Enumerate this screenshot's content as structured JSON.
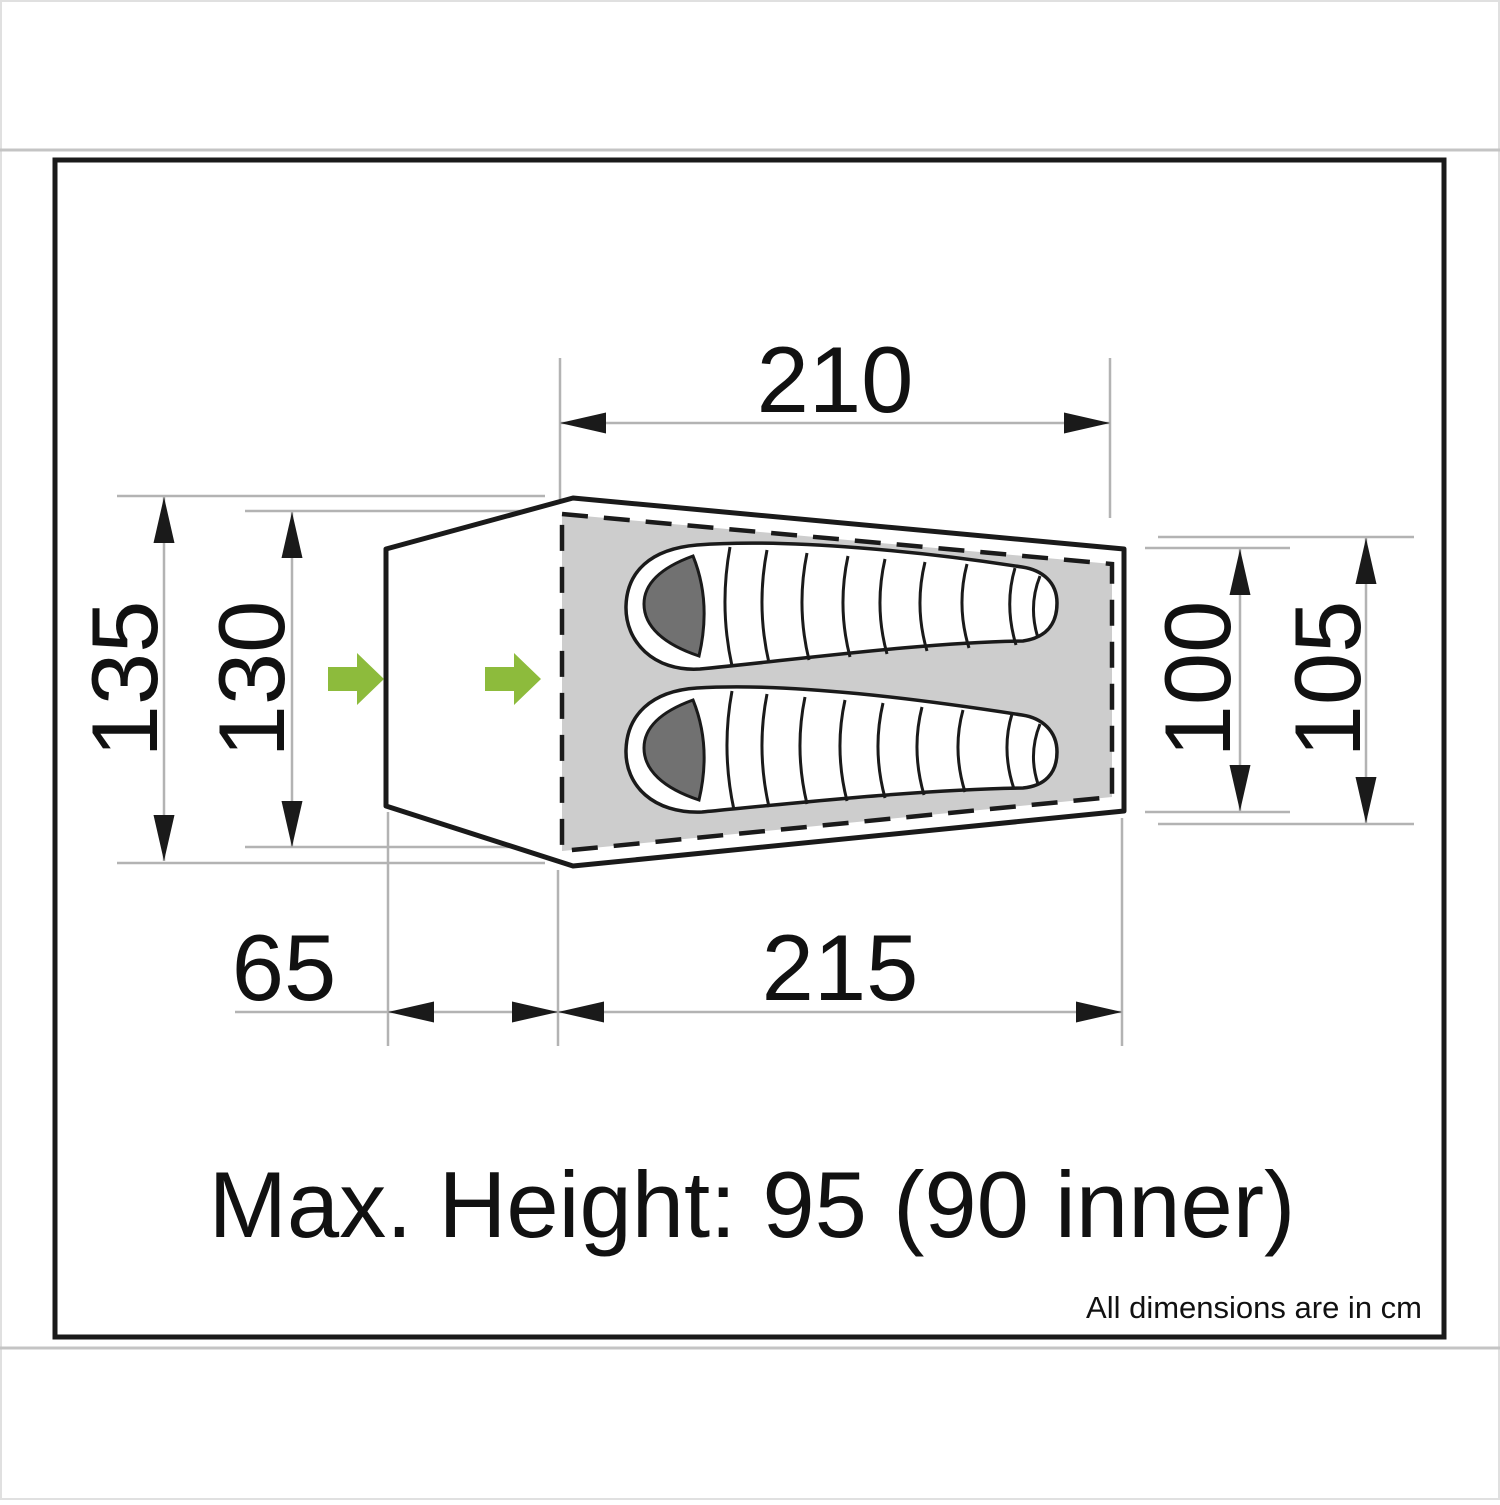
{
  "dimensions": {
    "top_length": "210",
    "left_outer_width": "135",
    "left_inner_width": "130",
    "right_inner_width": "100",
    "right_outer_width": "105",
    "porch_depth": "65",
    "floor_length": "215"
  },
  "notes": {
    "max_height": "Max. Height: 95 (90 inner)",
    "units": "All dimensions are in cm"
  },
  "colors": {
    "outline_black": "#1a1a1a",
    "dim_line_gray": "#b3b3b3",
    "floor_gray": "#cdcdcd",
    "hood_gray": "#717171",
    "accent_green": "#8dbb3c",
    "band_line_gray": "#c4c4c4"
  }
}
